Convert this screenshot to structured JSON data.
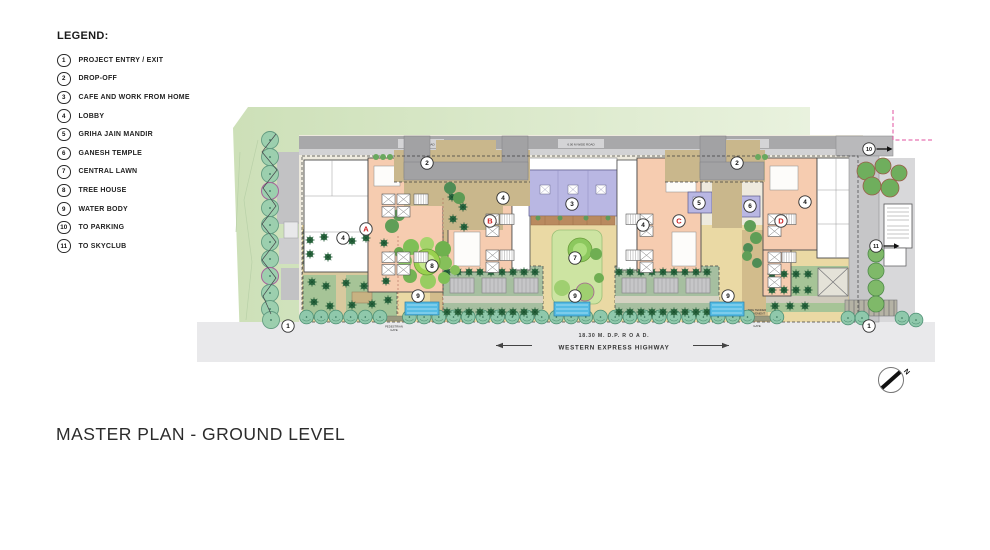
{
  "legend": {
    "title": "LEGEND:",
    "items": [
      {
        "num": "1",
        "label": "PROJECT ENTRY / EXIT"
      },
      {
        "num": "2",
        "label": "DROP-OFF"
      },
      {
        "num": "3",
        "label": "CAFE AND WORK FROM HOME"
      },
      {
        "num": "4",
        "label": "LOBBY"
      },
      {
        "num": "5",
        "label": "GRIHA JAIN MANDIR"
      },
      {
        "num": "6",
        "label": "GANESH TEMPLE"
      },
      {
        "num": "7",
        "label": "CENTRAL LAWN"
      },
      {
        "num": "8",
        "label": "TREE HOUSE"
      },
      {
        "num": "9",
        "label": "WATER BODY"
      },
      {
        "num": "10",
        "label": "TO PARKING"
      },
      {
        "num": "11",
        "label": "TO SKYCLUB"
      }
    ]
  },
  "title": "MASTER PLAN - GROUND LEVEL",
  "plan": {
    "dp_road_label": "18.30 M.   D.P.    R O A D.",
    "highway_label": "WESTERN EXPRESS HIGHWAY",
    "side_road_label": "6.00 M WIDE ROAD",
    "gate_left_line1": "PEDESTRIAN",
    "gate_left_line2": "GATE",
    "gate_right_line1": "FIRE TENDER",
    "gate_right_line2": "MOVEMENT",
    "gate_right_line3": "GATE",
    "north_label": "N",
    "colors": {
      "landscape_green": "#d5e6c2",
      "building_core_salmon": "#f6ccb0",
      "amenity_lavender": "#b9b7e3",
      "plaza_yellow": "#ead9a4",
      "water_blue": "#55bce4",
      "marker_letter_red": "#cc2020",
      "boundary_pink": "#e0529f"
    },
    "building_markers": [
      {
        "label": "A",
        "x": 366,
        "y": 229
      },
      {
        "label": "B",
        "x": 490,
        "y": 221
      },
      {
        "label": "C",
        "x": 679,
        "y": 221
      },
      {
        "label": "D",
        "x": 781,
        "y": 221
      }
    ],
    "number_markers": [
      {
        "num": "1",
        "x": 288,
        "y": 326
      },
      {
        "num": "1",
        "x": 869,
        "y": 326
      },
      {
        "num": "2",
        "x": 427,
        "y": 163
      },
      {
        "num": "2",
        "x": 737,
        "y": 163
      },
      {
        "num": "3",
        "x": 572,
        "y": 204
      },
      {
        "num": "4",
        "x": 343,
        "y": 238
      },
      {
        "num": "4",
        "x": 503,
        "y": 198
      },
      {
        "num": "4",
        "x": 643,
        "y": 225
      },
      {
        "num": "4",
        "x": 805,
        "y": 202
      },
      {
        "num": "5",
        "x": 699,
        "y": 203
      },
      {
        "num": "6",
        "x": 750,
        "y": 206
      },
      {
        "num": "7",
        "x": 575,
        "y": 258
      },
      {
        "num": "8",
        "x": 432,
        "y": 266
      },
      {
        "num": "9",
        "x": 418,
        "y": 296
      },
      {
        "num": "9",
        "x": 575,
        "y": 296
      },
      {
        "num": "9",
        "x": 728,
        "y": 296
      },
      {
        "num": "10",
        "x": 869,
        "y": 149,
        "arrow": true
      },
      {
        "num": "11",
        "x": 876,
        "y": 246,
        "arrow": true
      }
    ]
  }
}
